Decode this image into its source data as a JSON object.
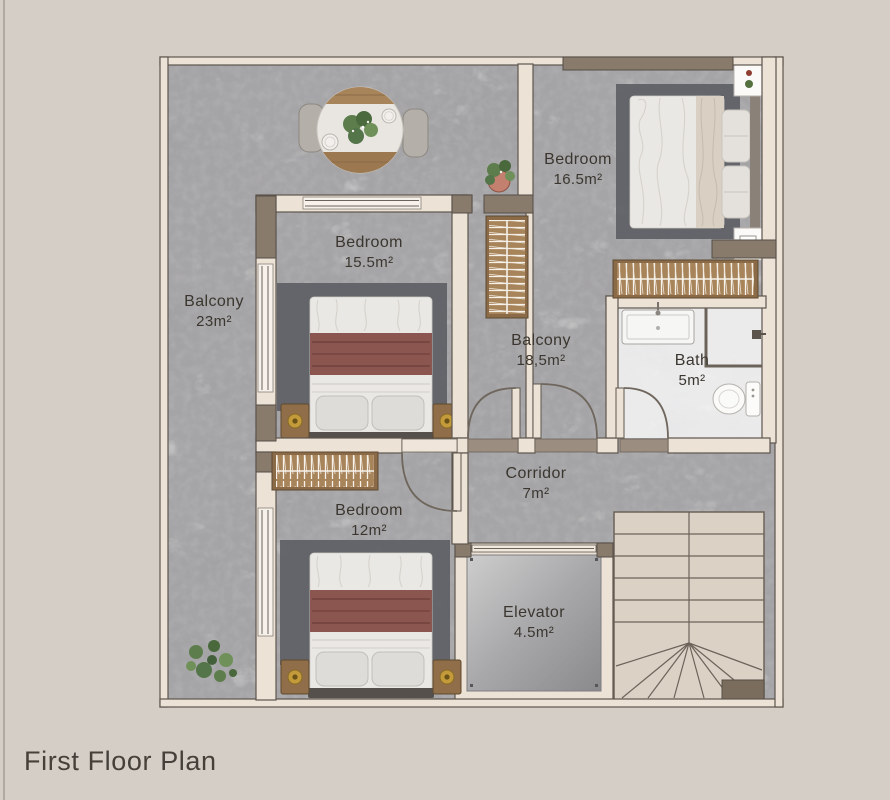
{
  "title": "First Floor Plan",
  "rooms": [
    {
      "name": "Balcony",
      "area": "23m²"
    },
    {
      "name": "Bedroom",
      "area": "15.5m²"
    },
    {
      "name": "Bedroom",
      "area": "16.5m²"
    },
    {
      "name": "Balcony",
      "area": "18,5m²"
    },
    {
      "name": "Bath",
      "area": "5m²"
    },
    {
      "name": "Corridor",
      "area": "7m²"
    },
    {
      "name": "Bedroom",
      "area": "12m²"
    },
    {
      "name": "Elevator",
      "area": "4.5m²"
    }
  ],
  "furniture_icons": [
    "dining-table-icon",
    "chair-icon",
    "double-bed-icon",
    "nightstand-icon",
    "lamp-icon",
    "wardrobe-hangers-icon",
    "plant-icon",
    "sink-icon",
    "shower-icon",
    "toilet-icon",
    "staircase-icon",
    "elevator-cab-icon",
    "door-swing-icon",
    "window-icon"
  ],
  "colors": {
    "page_bg": "#d5cec6",
    "floor_marble": "#a5a4a6",
    "bath_marble": "#ebebec",
    "wall_cream": "#ece2d6",
    "wall_dark": "#897b6c",
    "wall_outline": "#5e564d",
    "wood": "#a8845b",
    "rug": "#5d6065",
    "blanket_maroon": "#8c5650",
    "duvet": "#eae8e4",
    "stair_tread": "#dcd1c5",
    "elevator_metal": "#a8a8aa",
    "gold_lamp": "#c49b3a",
    "plant_green": "#5d7d4c",
    "text": "#3b362f"
  }
}
